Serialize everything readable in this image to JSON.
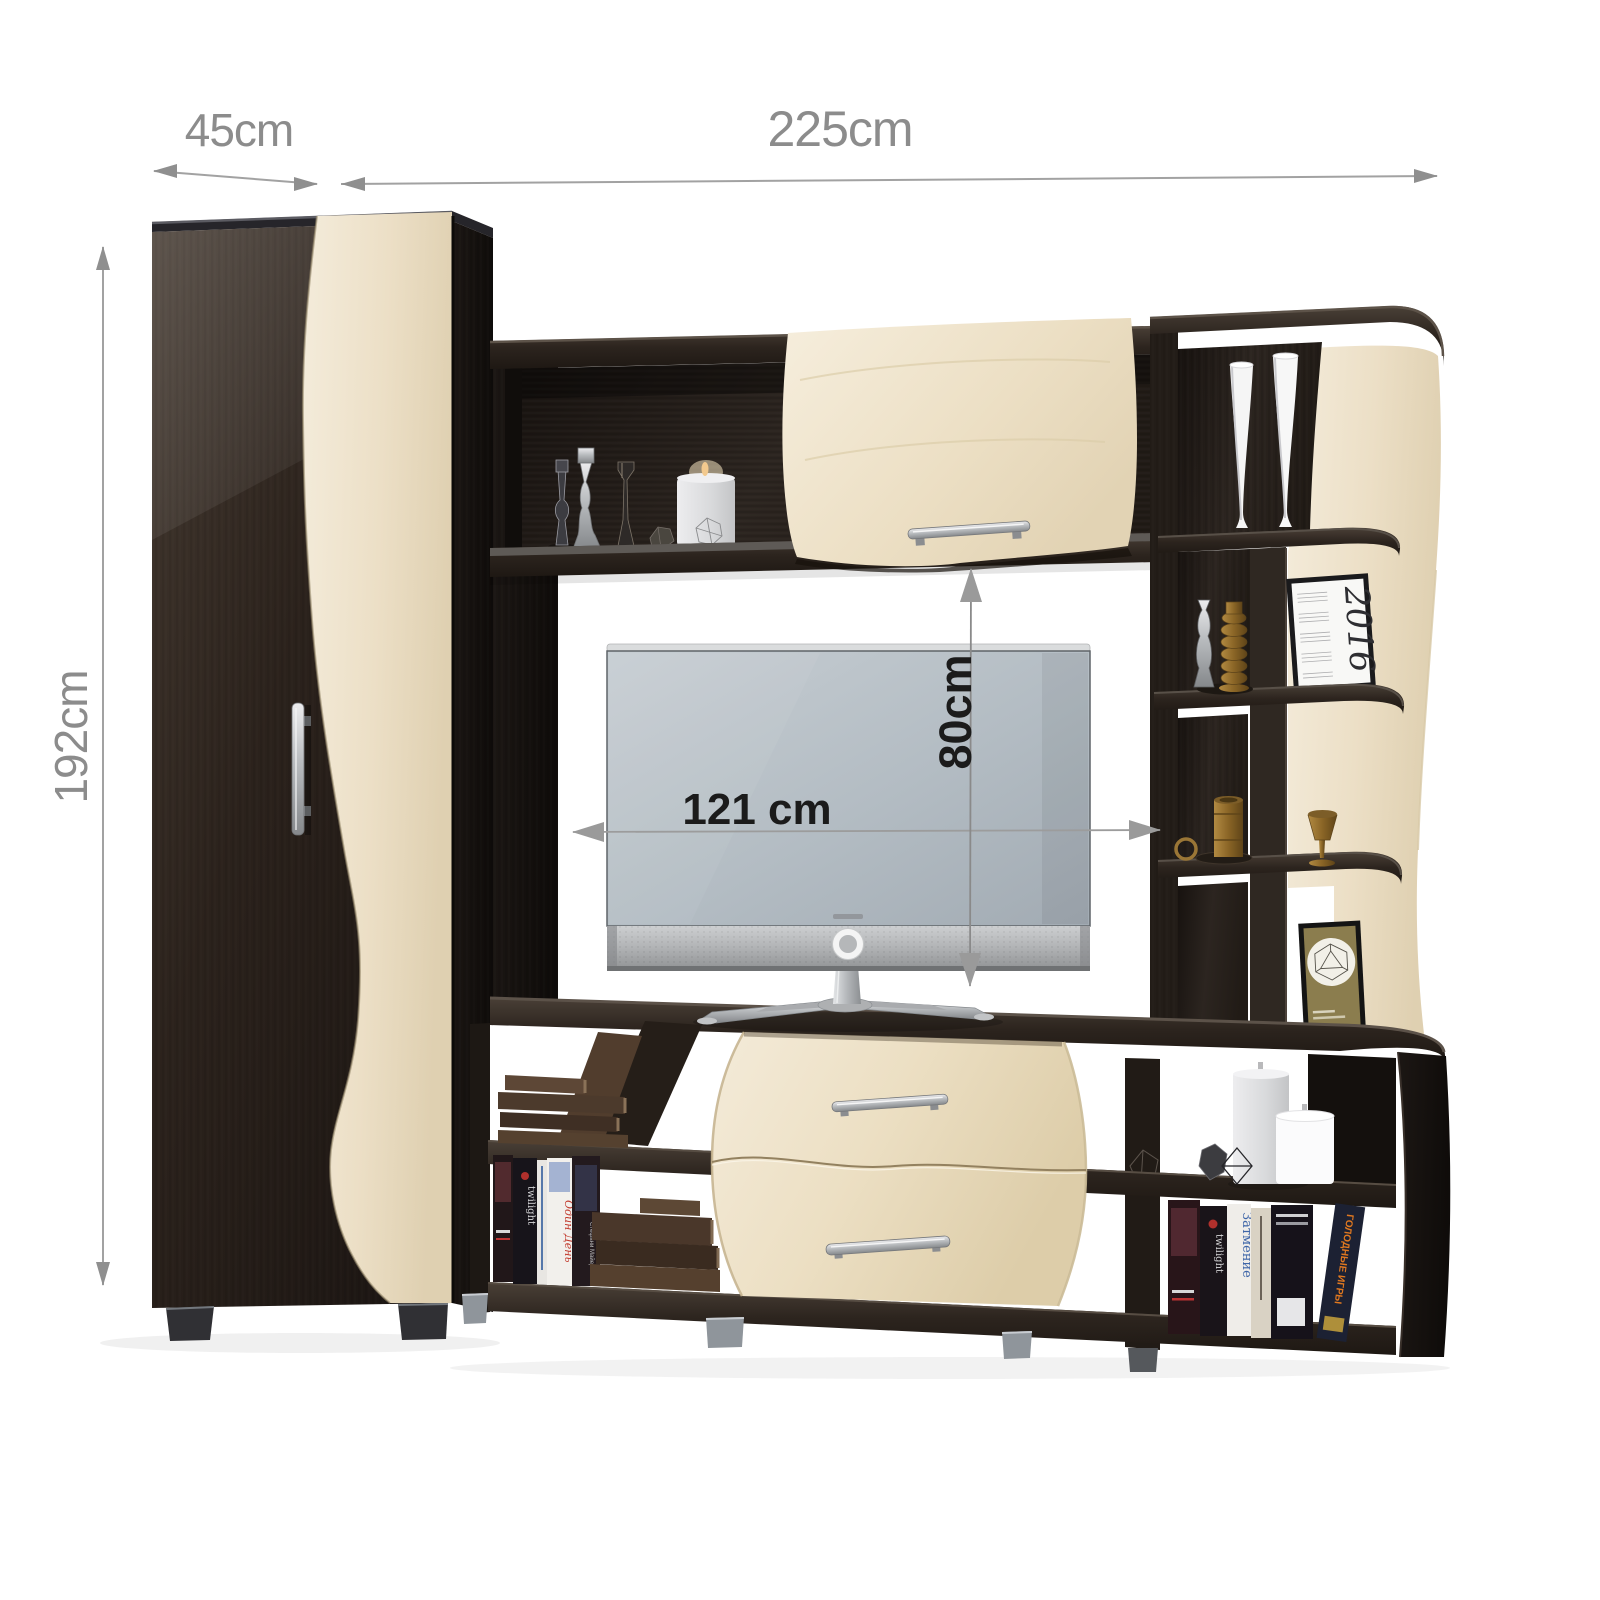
{
  "dimension_labels": {
    "wardrobe_width": "45cm",
    "total_width": "225cm",
    "total_height": "192cm",
    "tv_niche_width": "121 cm",
    "tv_niche_height": "80cm"
  },
  "decor": {
    "calendar_year": "2016",
    "book_spines": {
      "twilight_left": "twilight",
      "odin_den": "Один День",
      "twilight_right": "twilight",
      "zatmenie": "Затмение",
      "stefani_mayer": "Стефани Майер",
      "golodnye_igry": "ГОЛОДНЫЕ ИГРЫ"
    }
  },
  "colors": {
    "background": "#ffffff",
    "wenge_dark_wood": "#2f2823",
    "wenge_deep_shadow": "#16110e",
    "maple_light_wood": "#efe5cf",
    "silver_hardware": "#b9bcbf",
    "dimension_text_outer": "#8c8c8c",
    "dimension_text_tv": "#1b1b1b",
    "arrow_gray": "#949494",
    "tv_screen": "#b3bcc3",
    "brass": "#9a7636",
    "candle_white": "#f4f4f5"
  }
}
